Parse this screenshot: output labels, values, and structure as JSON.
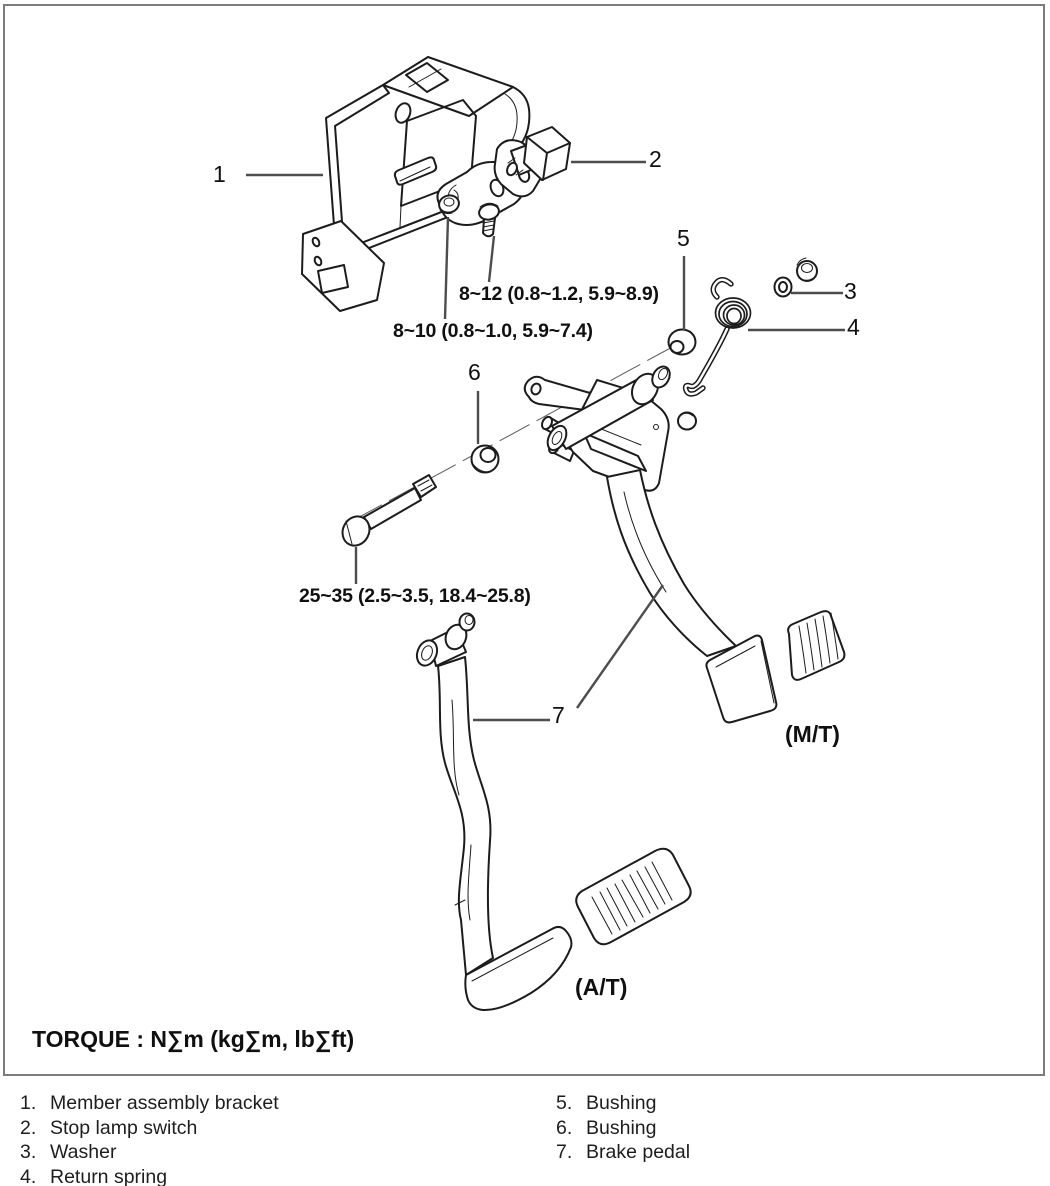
{
  "diagram": {
    "part_labels": {
      "p1": "1",
      "p2": "2",
      "p3": "3",
      "p4": "4",
      "p5": "5",
      "p6": "6",
      "p7": "7"
    },
    "torque_callouts": {
      "switch_bolt": "8~12 (0.8~1.2, 5.9~8.9)",
      "switch_nut": "8~10 (0.8~1.0, 5.9~7.4)",
      "pivot_bolt": "25~35 (2.5~3.5, 18.4~25.8)"
    },
    "transmission_labels": {
      "manual": "(M/T)",
      "automatic": "(A/T)"
    },
    "torque_note": "TORQUE : N∑m (kg∑m, lb∑ft)"
  },
  "parts_list": {
    "items": [
      {
        "num": "1.",
        "label": "Member assembly bracket"
      },
      {
        "num": "2.",
        "label": "Stop lamp switch"
      },
      {
        "num": "3.",
        "label": "Washer"
      },
      {
        "num": "4.",
        "label": "Return spring"
      },
      {
        "num": "5.",
        "label": "Bushing"
      },
      {
        "num": "6.",
        "label": "Bushing"
      },
      {
        "num": "7.",
        "label": "Brake pedal"
      }
    ]
  },
  "colors": {
    "line": "#1c1c1c",
    "leader": "#4d4d4d",
    "frame_border": "#7d7d7d",
    "background": "#ffffff"
  }
}
